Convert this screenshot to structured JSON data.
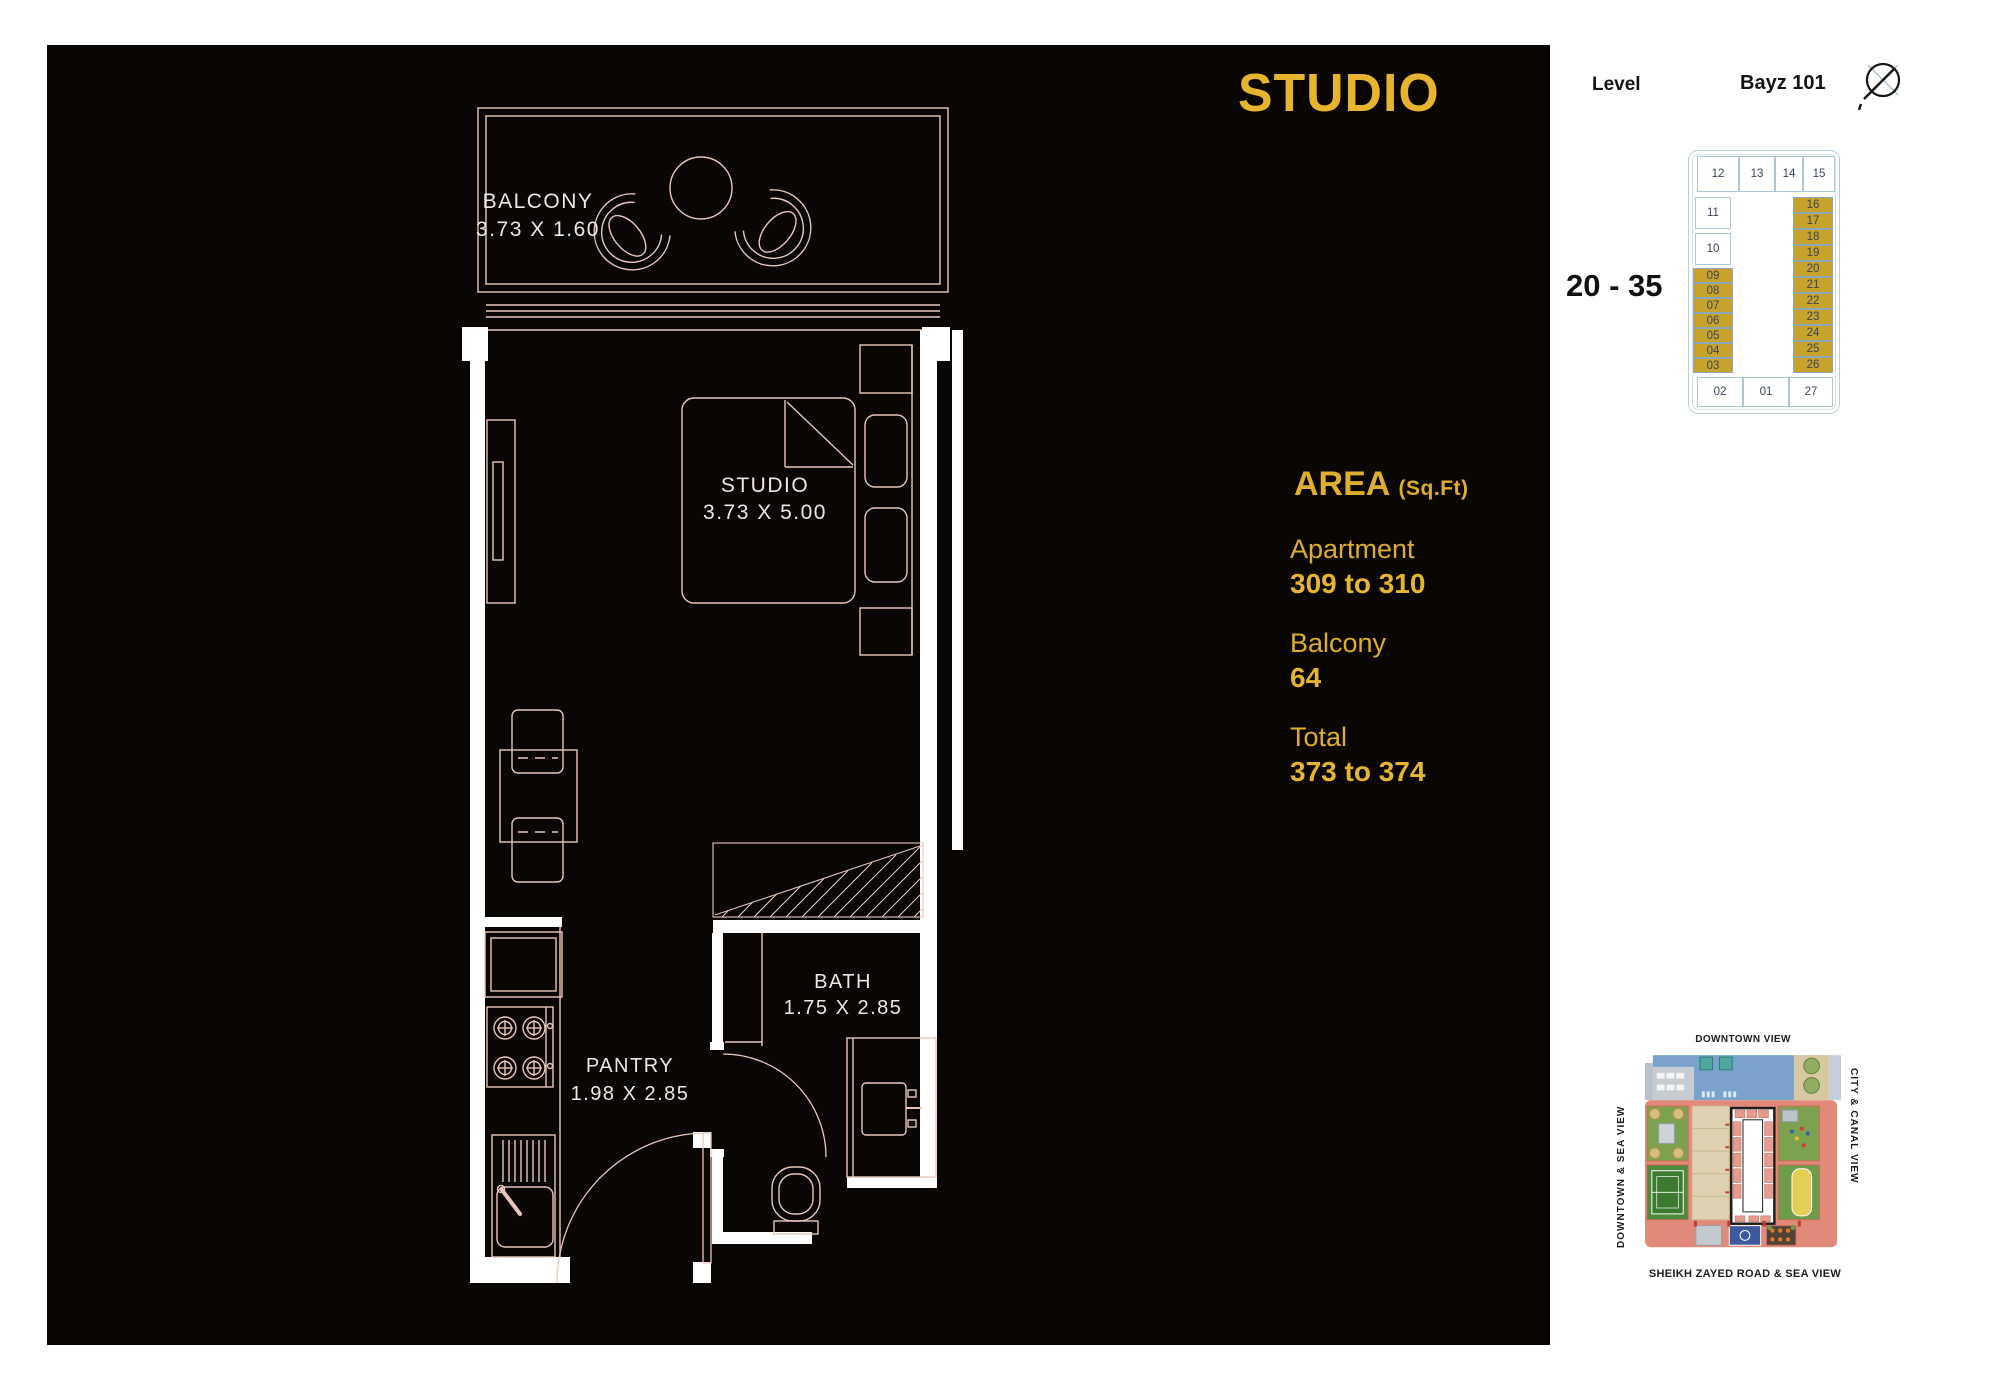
{
  "title": "STUDIO",
  "header": {
    "level_label": "Level",
    "building": "Bayz 101"
  },
  "levels_range": "20 - 35",
  "stack_plan": {
    "top_row": [
      "12",
      "13",
      "14",
      "15"
    ],
    "left_upper": [
      "11",
      "10"
    ],
    "left_gold": [
      "09",
      "08",
      "07",
      "06",
      "05",
      "04",
      "03"
    ],
    "right_gold": [
      "16",
      "17",
      "18",
      "19",
      "20",
      "21",
      "22",
      "23",
      "24",
      "25",
      "26"
    ],
    "bottom_row": [
      "02",
      "01",
      "27"
    ]
  },
  "area": {
    "heading": "AREA",
    "heading_unit": "(Sq.Ft)",
    "rows": [
      {
        "label": "Apartment",
        "value": "309 to 310"
      },
      {
        "label": "Balcony",
        "value": "64"
      },
      {
        "label": "Total",
        "value": "373 to 374"
      }
    ]
  },
  "floor_plan": {
    "rooms": [
      {
        "name": "BALCONY",
        "dims": "3.73 X 1.60"
      },
      {
        "name": "STUDIO",
        "dims": "3.73 X 5.00"
      },
      {
        "name": "BATH",
        "dims": "1.75 X 2.85"
      },
      {
        "name": "PANTRY",
        "dims": "1.98 X 2.85"
      }
    ]
  },
  "site_map": {
    "top_label": "DOWNTOWN VIEW",
    "right_label": "CITY & CANAL VIEW",
    "bottom_label": "SHEIKH ZAYED ROAD & SEA VIEW",
    "left_label": "DOWNTOWN & SEA VIEW"
  },
  "colors": {
    "gold_text": "#e7b42f",
    "gold_fill": "#c8a32b",
    "navy_text": "#39435c",
    "plan_line": "#e8c7b8",
    "wall_white": "#ffffff",
    "salmon": "#e28a7a",
    "pool_blue": "#7aa3cc",
    "green": "#7ca24f"
  }
}
